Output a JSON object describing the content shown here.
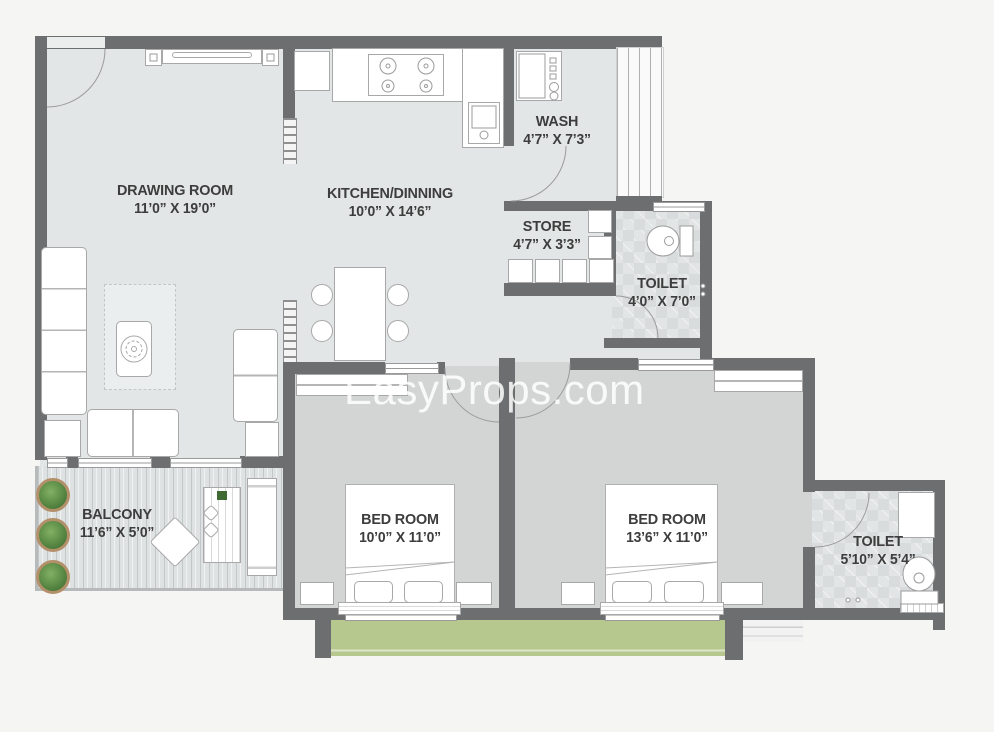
{
  "watermark": {
    "text": "EasyProps.com"
  },
  "rooms": [
    {
      "id": "drawing-room",
      "name": "DRAWING ROOM",
      "dims": "11’0” X 19’0”"
    },
    {
      "id": "kitchen",
      "name": "KITCHEN/DINNING",
      "dims": "10’0” X 14’6”"
    },
    {
      "id": "wash",
      "name": "WASH",
      "dims": "4’7” X 7’3”"
    },
    {
      "id": "store",
      "name": "STORE",
      "dims": "4’7” X 3’3”"
    },
    {
      "id": "toilet-1",
      "name": "TOILET",
      "dims": "4’0” X 7’0”"
    },
    {
      "id": "balcony",
      "name": "BALCONY",
      "dims": "11’6” X 5’0”"
    },
    {
      "id": "bedroom-1",
      "name": "BED ROOM",
      "dims": "10’0” X 11’0”"
    },
    {
      "id": "bedroom-2",
      "name": "BED ROOM",
      "dims": "13’6” X 11’0”"
    },
    {
      "id": "toilet-2",
      "name": "TOILET",
      "dims": "5’10” X 5’4”"
    }
  ],
  "colors": {
    "wall": "#6d6e70",
    "floor": "#e3e6e6",
    "bedroom_floor": "#d3d5d5",
    "toilet_floor": "#e2e5e5",
    "balcony_green": "#b7c88e",
    "label_text": "#3d3d3d",
    "watermark": "#ffffff"
  }
}
